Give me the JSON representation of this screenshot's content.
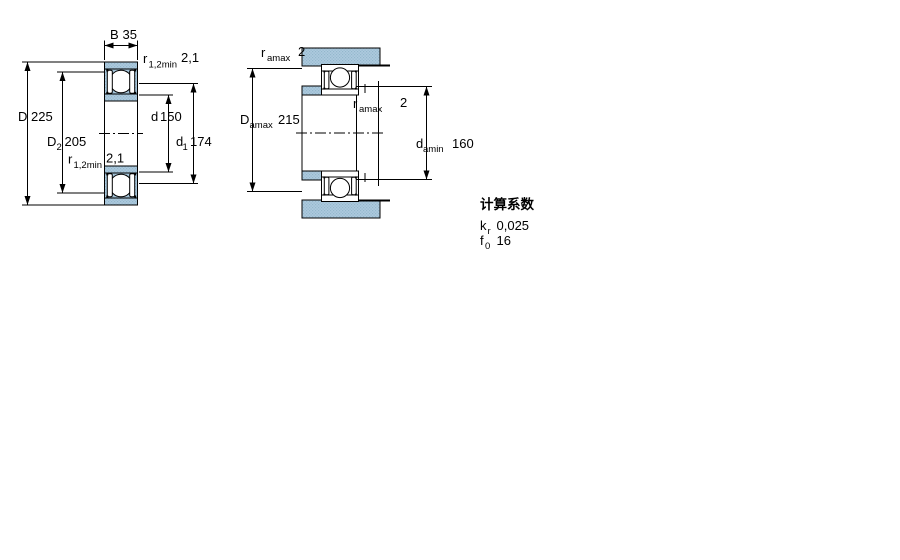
{
  "diagram": {
    "kind": "bearing cross-section dimension drawing",
    "left_figure": {
      "description": "bearing principal dimensions",
      "dims": {
        "B": {
          "symbol": "B",
          "sub": "",
          "value": "35"
        },
        "r12_top": {
          "symbol": "r",
          "sub": "1,2min",
          "value": "2,1"
        },
        "D": {
          "symbol": "D",
          "sub": "",
          "value": "225"
        },
        "D2": {
          "symbol": "D",
          "sub": "2",
          "value": "205"
        },
        "d": {
          "symbol": "d",
          "sub": "",
          "value": "150"
        },
        "d1": {
          "symbol": "d",
          "sub": "1",
          "value": "174"
        },
        "r12_bottom": {
          "symbol": "r",
          "sub": "1,2min",
          "value": "2,1"
        }
      }
    },
    "right_figure": {
      "description": "abutment and fillet dimensions",
      "dims": {
        "ra_top": {
          "symbol": "r",
          "sub": "amax",
          "value": "2"
        },
        "Da": {
          "symbol": "D",
          "sub": "amax",
          "value": "215"
        },
        "ra_mid": {
          "symbol": "r",
          "sub": "amax",
          "value": "2"
        },
        "da": {
          "symbol": "d",
          "sub": "amin",
          "value": "160"
        }
      }
    },
    "calculation_factors": {
      "title": "计算系数",
      "rows": [
        {
          "symbol": "k",
          "sub": "r",
          "value": "0,025"
        },
        {
          "symbol": "f",
          "sub": "0",
          "value": "16"
        }
      ]
    },
    "colors": {
      "steel_fill": "#adcade",
      "steel_dot": "#93b7cc",
      "line": "#000000",
      "background": "#ffffff"
    }
  }
}
